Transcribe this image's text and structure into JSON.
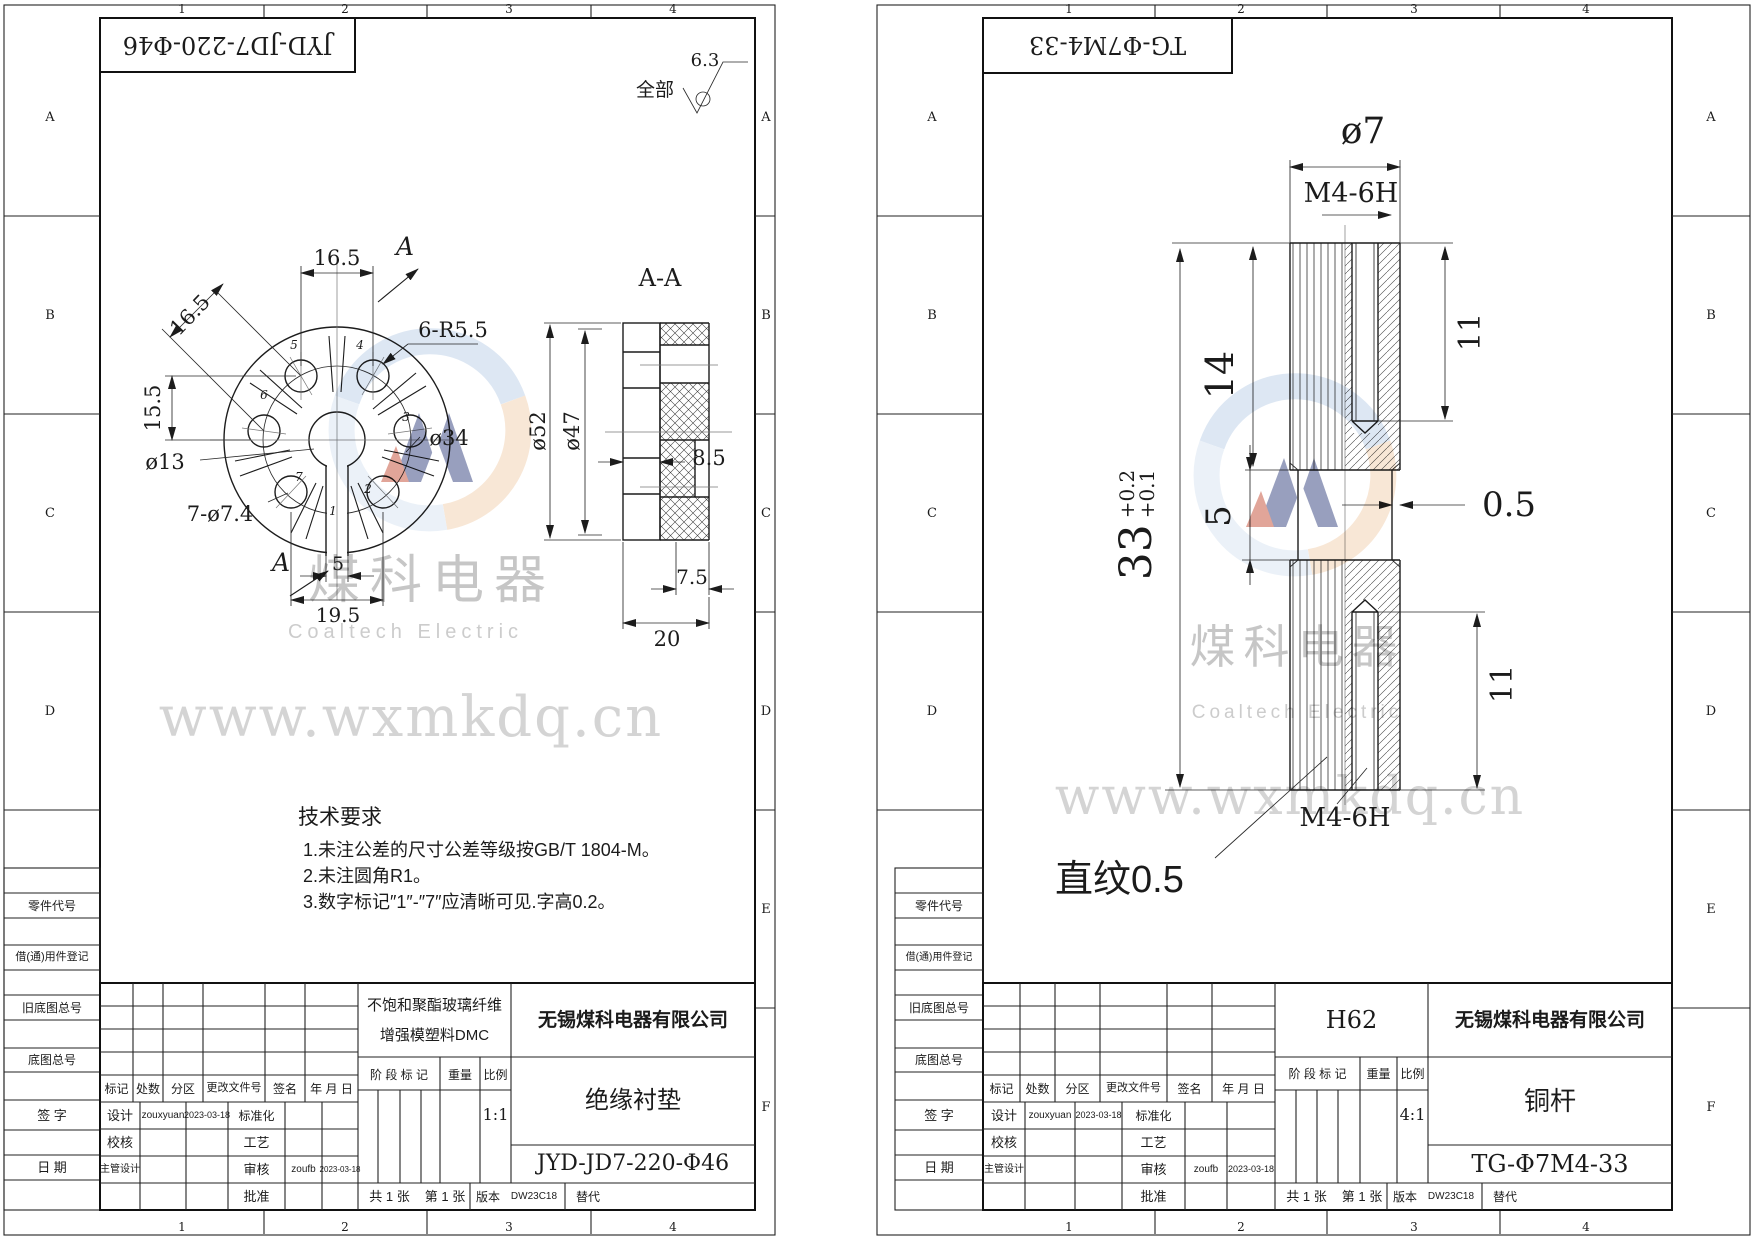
{
  "watermark": {
    "cn": "煤科电器",
    "en": "Coaltech Electric",
    "url": "www.wxmkdq.cn"
  },
  "zone": {
    "c1": "1",
    "c2": "2",
    "c3": "3",
    "c4": "4",
    "rA": "A",
    "rB": "B",
    "rC": "C",
    "rD": "D",
    "rE": "E",
    "rF": "F"
  },
  "margin": {
    "part_code": "零件代号",
    "borrow": "借(通)用件登记",
    "old_base": "旧底图总号",
    "base": "底图总号",
    "sign": "签 字",
    "date": "日 期"
  },
  "tb": {
    "mark": "标记",
    "count": "处数",
    "zone": "分区",
    "change_no": "更改文件号",
    "sign": "签名",
    "ymd": "年 月 日",
    "stage": "阶 段 标 记",
    "weight": "重量",
    "scale_label": "比例",
    "design": "设计",
    "standardize": "标准化",
    "check": "校核",
    "process": "工艺",
    "chief": "主管设计",
    "audit": "审核",
    "approve": "批准",
    "designer": "zouxyuan",
    "design_date": "2023-03-18",
    "auditor": "zoufb",
    "audit_date": "2023-03-18",
    "sheets_total": "共 1 张",
    "sheet_no": "第 1 张",
    "version_label": "版本",
    "version": "DW23C18",
    "replace": "替代"
  },
  "left": {
    "doc_no": "JYD-JD7-220-Φ46",
    "finish_scope": "全部",
    "finish_value": "6.3",
    "section": "A-A",
    "arrow_label": "A",
    "dim": {
      "p165t": "16.5",
      "p165d": "16.5",
      "p155": "15.5",
      "d13": "ø13",
      "holes": "7-ø7.4",
      "d34": "ø34",
      "r": "6-R5.5",
      "slot_w": "5",
      "p195": "19.5",
      "d52": "ø52",
      "d47": "ø47",
      "t85": "8.5",
      "t75": "7.5",
      "t20": "20"
    },
    "nums": {
      "n1": "1",
      "n2": "2",
      "n3": "3",
      "n4": "4",
      "n5": "5",
      "n6": "6",
      "n7": "7"
    },
    "tech": {
      "title": "技术要求",
      "l1": "1.未注公差的尺寸公差等级按GB/T 1804-M。",
      "l2": "2.未注圆角R1。",
      "l3": "3.数字标记″1″-″7″应清晰可见.字高0.2。"
    },
    "material1": "不饱和聚酯玻璃纤维",
    "material2": "增强模塑料DMC",
    "company": "无锡煤科电器有限公司",
    "part": "绝缘衬垫",
    "scale": "1:1"
  },
  "right": {
    "doc_no": "TG-Φ7M4-33",
    "dim": {
      "d7": "ø7",
      "m4t": "M4-6H",
      "p14": "14",
      "p11t": "11",
      "p33": "33",
      "tol_u": "+0.2",
      "tol_l": "+0.1",
      "p5": "5",
      "p05": "0.5",
      "p11b": "11",
      "m4b": "M4-6H",
      "knurl": "直纹0.5"
    },
    "material": "H62",
    "company": "无锡煤科电器有限公司",
    "part": "铜杆",
    "scale": "4:1"
  },
  "colors": {
    "line": "#1c1c1c",
    "watermark_text": "#c9c9c9",
    "logo_blue": "#bcd0e8",
    "logo_orange": "#f1cfae",
    "logo_navy": "#32407e",
    "logo_red": "#c44d35"
  }
}
